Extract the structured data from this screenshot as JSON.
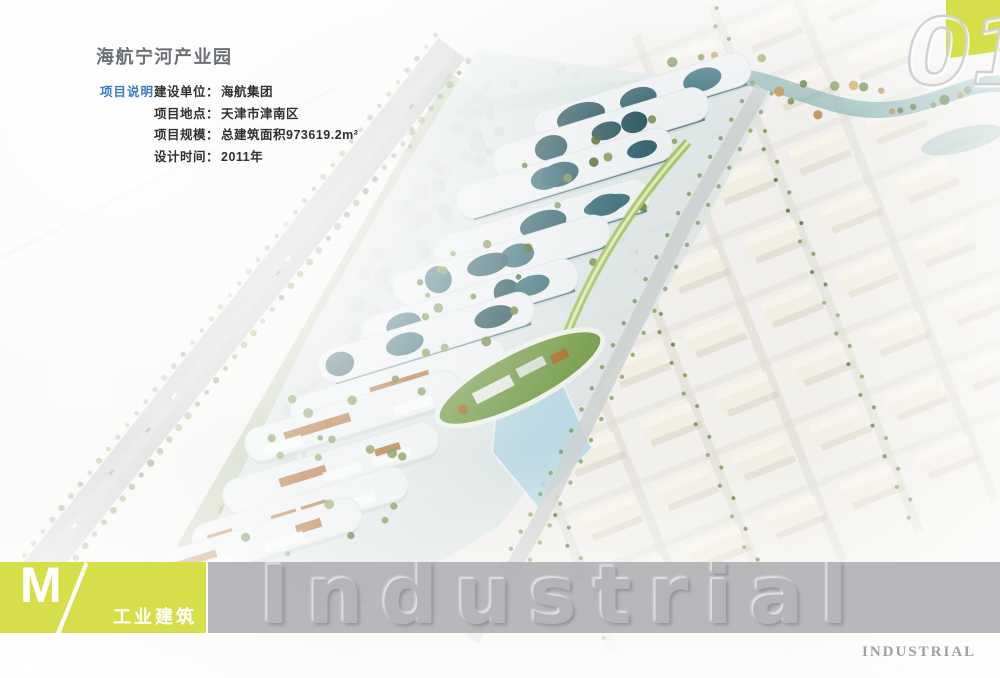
{
  "header": {
    "title": "海航宁河产业园"
  },
  "project_info": {
    "section_label": "项目说明",
    "rows": [
      {
        "label": "建设单位：",
        "value": "海航集团"
      },
      {
        "label": "项目地点：",
        "value": "天津市津南区"
      },
      {
        "label": "项目规模：",
        "value": "总建筑面积973619.2m²"
      },
      {
        "label": "设计时间：",
        "value": "2011年"
      }
    ]
  },
  "corner": {
    "page_number": "01"
  },
  "footer": {
    "category_letter": "M",
    "category_name": "工业建筑",
    "watermark": "Industrial",
    "watermark_caps": "INDUSTRIAL"
  },
  "colors": {
    "accent_yellow": "#d6df49",
    "label_blue": "#3a7cc2",
    "band_gray": "#b1b0b4",
    "title_gray": "#6c7074"
  }
}
